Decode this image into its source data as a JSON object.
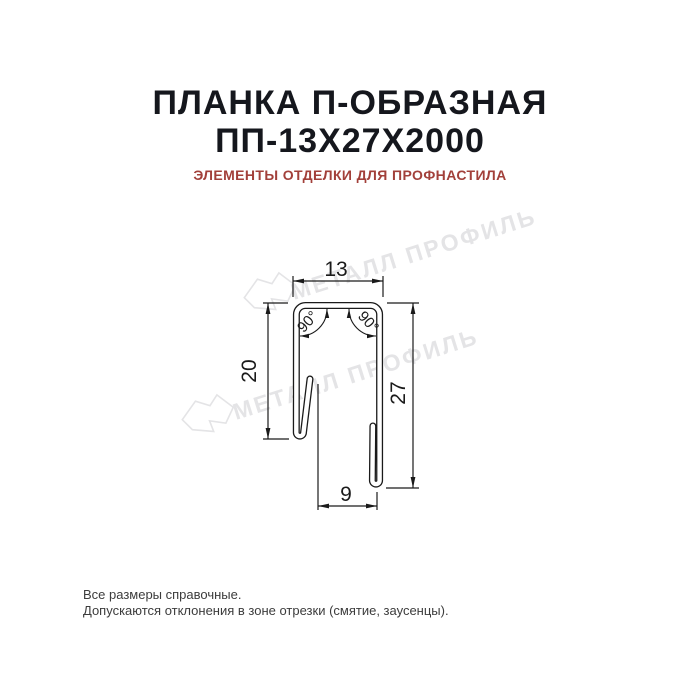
{
  "header": {
    "title_line1": "ПЛАНКА П-ОБРАЗНАЯ",
    "title_line2": "ПП-13Х27Х2000",
    "subtitle": "ЭЛЕМЕНТЫ ОТДЕЛКИ ДЛЯ ПРОФНАСТИЛА"
  },
  "drawing": {
    "dim_top_width": "13",
    "dim_left_height": "20",
    "dim_right_height": "27",
    "dim_bottom_width": "9",
    "angle_left": "90°",
    "angle_right": "90°"
  },
  "watermark": {
    "text": "МЕТАЛЛ ПРОФИЛЬ"
  },
  "footer": {
    "line1": "Все размеры справочные.",
    "line2": "Допускаются отклонения в зоне отрезки (смятие, заусенцы)."
  },
  "colors": {
    "background": "#ffffff",
    "line": "#1a1a1a",
    "title": "#15171d",
    "subtitle_accent": "#a2403a",
    "watermark": "#e4e4e6",
    "footer_text": "#3c3c3c"
  }
}
